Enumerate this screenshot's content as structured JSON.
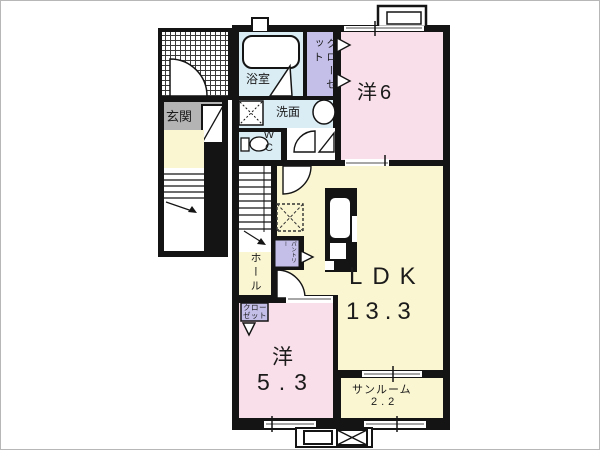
{
  "plan": {
    "labels": {
      "genkan": "玄関",
      "bathroom": "浴室",
      "closet_top": "クローゼット",
      "washroom": "洗面",
      "wc": "WC",
      "room6": "洋6",
      "hall": "ホール",
      "pantry": "パントリー",
      "closet_bottom": "クロー\nゼット",
      "ldk": "LDK",
      "ldk_size": "13.3",
      "room53": "洋",
      "room53_size": "5.3",
      "sunroom": "サンルーム",
      "sunroom_size": "2.2"
    },
    "colors": {
      "wall": "#141414",
      "room_pink": "#f9dfe9",
      "room_yellow": "#fbf6d2",
      "room_blue": "#daedf5",
      "closet_purple": "#c4bfe9",
      "genkan_gray": "#b4b4b4",
      "window_line": "#8a8a8a",
      "floor_white": "#ffffff"
    }
  }
}
